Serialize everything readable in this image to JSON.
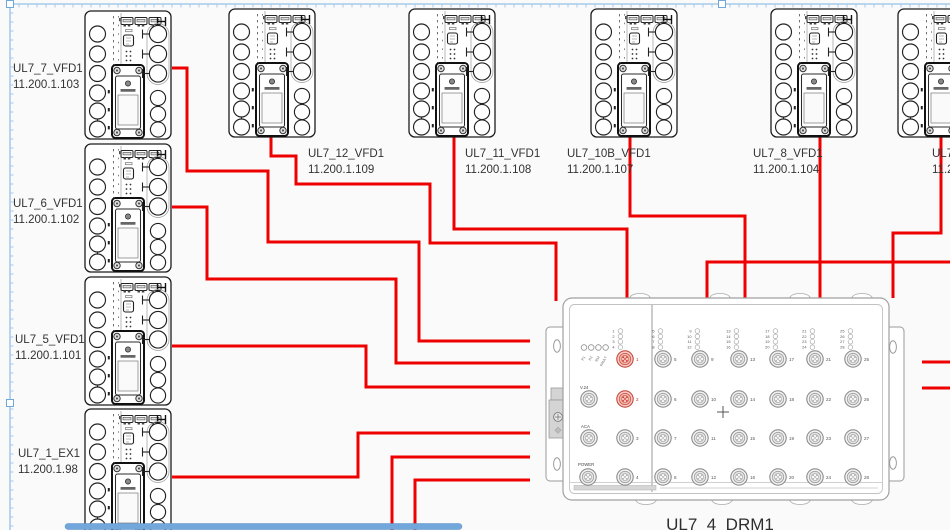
{
  "diagram": {
    "background": "#FAFAFA",
    "wire_color": "#EF0000",
    "selection": {
      "color": "#A5CBEA",
      "handle_fill": "#FFFFFF",
      "handle_border": "#6FA8DC",
      "top_y": 4,
      "left_x": 10,
      "tick_spacing": 9,
      "handles": [
        [
          10,
          4
        ],
        [
          722,
          4
        ],
        [
          10,
          403
        ]
      ]
    },
    "scrollbar": {
      "thumb_color": "#72A7DC",
      "thumb_border": "#5B8FC4",
      "x": 65,
      "width": 397
    }
  },
  "devices": [
    {
      "label": "UL7_7_VFD1",
      "ip": "11.200.1.103",
      "x": 84,
      "y": 10,
      "lx": 13,
      "ly": 72
    },
    {
      "label": "UL7_6_VFD1",
      "ip": "11.200.1.102",
      "x": 84,
      "y": 143,
      "lx": 13,
      "ly": 207
    },
    {
      "label": "UL7_5_VFD1",
      "ip": "11.200.1.101",
      "x": 84,
      "y": 276,
      "lx": 15,
      "ly": 343
    },
    {
      "label": "UL7_1_EX1",
      "ip": "11.200.1.98",
      "x": 84,
      "y": 408,
      "lx": 18,
      "ly": 457
    },
    {
      "label": "UL7_12_VFD1",
      "ip": "11.200.1.109",
      "x": 228,
      "y": 8,
      "lx": 308,
      "ly": 157
    },
    {
      "label": "UL7_11_VFD1",
      "ip": "11.200.1.108",
      "x": 408,
      "y": 8,
      "lx": 465,
      "ly": 157
    },
    {
      "label": "UL7_10B_VFD1",
      "ip": "11.200.1.107",
      "x": 590,
      "y": 8,
      "lx": 567,
      "ly": 157
    },
    {
      "label": "UL7_8_VFD1",
      "ip": "11.200.1.104",
      "x": 770,
      "y": 8,
      "lx": 753,
      "ly": 157
    },
    {
      "label": "UL7_",
      "ip": "11.2",
      "x": 897,
      "y": 8,
      "lx": 932,
      "ly": 157
    }
  ],
  "hub": {
    "label": "UL7_4_DRM1",
    "label_x": 720,
    "label_y": 530,
    "status_leds": [
      "P1",
      "P2",
      "RM",
      "FAULT"
    ],
    "aux_ports": [
      {
        "label": "V.24",
        "x": 589,
        "y": 399,
        "label_x": 580,
        "label_y": 389
      },
      {
        "label": "ACA",
        "x": 589,
        "y": 438,
        "label_x": 581,
        "label_y": 428
      },
      {
        "label": "POWER",
        "x": 588,
        "y": 477,
        "label_x": 578,
        "label_y": 466
      }
    ],
    "left_ports": [
      {
        "n": 1,
        "x": 625,
        "y": 359,
        "red": true
      },
      {
        "n": 2,
        "x": 625,
        "y": 399,
        "red": true
      },
      {
        "n": 3,
        "x": 625,
        "y": 438,
        "red": false
      },
      {
        "n": 4,
        "x": 625,
        "y": 477,
        "red": false
      }
    ],
    "left_bank": {
      "x": 617,
      "y": 329,
      "start": 1
    },
    "grid": {
      "cols": [
        663,
        700,
        739,
        778,
        815,
        853
      ],
      "rows": [
        359,
        399,
        438,
        477
      ],
      "start": 5,
      "bank_y": 329
    }
  },
  "wires": [
    {
      "from": "UL7_7_VFD1",
      "points": [
        [
          172,
          68
        ],
        [
          187,
          68
        ],
        [
          187,
          171
        ],
        [
          268,
          171
        ],
        [
          268,
          242
        ],
        [
          419,
          242
        ],
        [
          419,
          341
        ],
        [
          530,
          341
        ]
      ]
    },
    {
      "from": "UL7_6_VFD1",
      "points": [
        [
          172,
          207
        ],
        [
          207,
          207
        ],
        [
          207,
          279
        ],
        [
          396,
          279
        ],
        [
          396,
          363
        ],
        [
          530,
          363
        ]
      ]
    },
    {
      "from": "UL7_5_VFD1",
      "points": [
        [
          172,
          346
        ],
        [
          366,
          346
        ],
        [
          366,
          387
        ],
        [
          530,
          387
        ]
      ]
    },
    {
      "from": "UL7_1_EX1",
      "points": [
        [
          172,
          477
        ],
        [
          358,
          477
        ],
        [
          358,
          433
        ],
        [
          530,
          433
        ]
      ]
    },
    {
      "from": "offscreen-bottom-a",
      "points": [
        [
          392,
          532
        ],
        [
          392,
          457
        ],
        [
          530,
          457
        ]
      ]
    },
    {
      "from": "offscreen-bottom-b",
      "points": [
        [
          415,
          532
        ],
        [
          415,
          480
        ],
        [
          530,
          480
        ]
      ]
    },
    {
      "from": "UL7_12_VFD1",
      "points": [
        [
          271,
          137
        ],
        [
          271,
          156
        ],
        [
          296,
          156
        ],
        [
          296,
          184
        ],
        [
          430,
          184
        ],
        [
          430,
          243
        ],
        [
          556,
          243
        ],
        [
          556,
          301
        ]
      ]
    },
    {
      "from": "UL7_11_VFD1",
      "points": [
        [
          454,
          137
        ],
        [
          454,
          229
        ],
        [
          627,
          229
        ],
        [
          627,
          298
        ]
      ]
    },
    {
      "from": "UL7_10B_VFD1",
      "points": [
        [
          630,
          137
        ],
        [
          630,
          216
        ],
        [
          745,
          216
        ],
        [
          745,
          298
        ]
      ]
    },
    {
      "from": "UL7_8_VFD1",
      "points": [
        [
          820,
          137
        ],
        [
          820,
          298
        ]
      ]
    },
    {
      "from": "UL7_9",
      "points": [
        [
          941,
          137
        ],
        [
          941,
          233
        ],
        [
          893,
          233
        ],
        [
          893,
          298
        ]
      ]
    },
    {
      "from": "offscreen-right",
      "points": [
        [
          950,
          262
        ],
        [
          707,
          262
        ],
        [
          707,
          298
        ]
      ]
    },
    {
      "from": "stub-right-1",
      "points": [
        [
          950,
          362
        ],
        [
          922,
          362
        ]
      ]
    },
    {
      "from": "stub-right-2",
      "points": [
        [
          950,
          388
        ],
        [
          922,
          388
        ]
      ]
    }
  ]
}
